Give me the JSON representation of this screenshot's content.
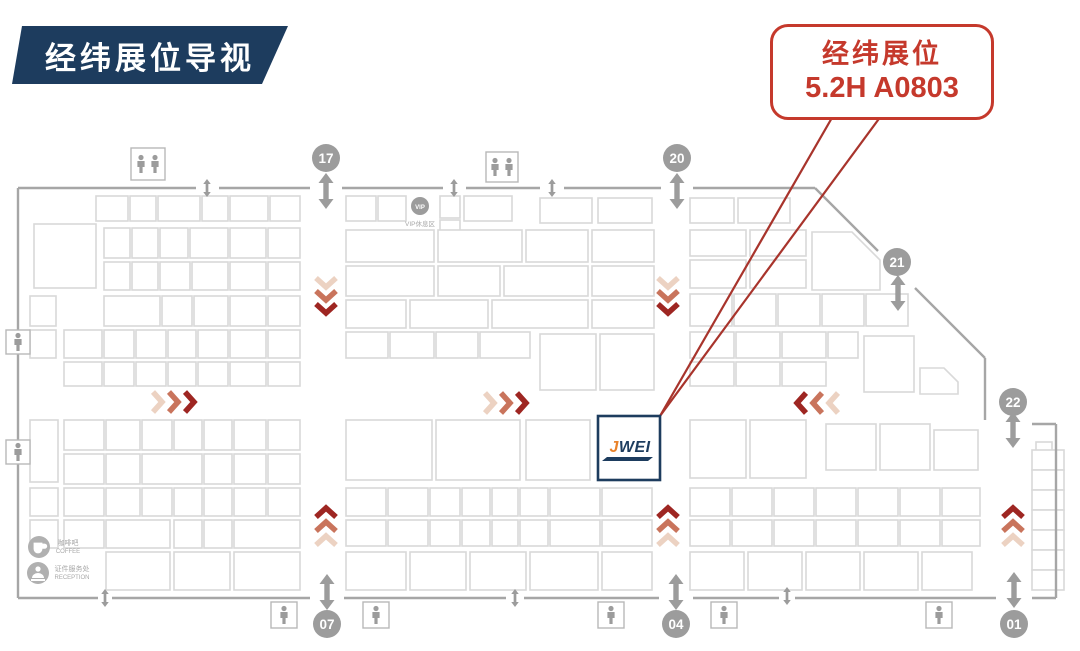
{
  "banner": {
    "title": "经纬展位导视"
  },
  "callout": {
    "line1": "经纬展位",
    "line2": "5.2H A0803"
  },
  "jwei_booth": {
    "logo_j": "J",
    "logo_wei": "WEI"
  },
  "gates": {
    "g17": "17",
    "g20": "20",
    "g21": "21",
    "g22": "22",
    "g07": "07",
    "g04": "04",
    "g01": "01"
  },
  "facilities": {
    "vip_label": "VIP休息区",
    "coffee_zh": "咖啡吧",
    "coffee_en": "COFFEE",
    "reception_zh": "证件服务处",
    "reception_en": "RECEPTION"
  },
  "icons": {
    "restroom": "wc-figures",
    "vip": "vip-lounge-circle",
    "coffee": "coffee-cup-circle",
    "reception": "reception-desk-circle",
    "gate_arrow": "double-headed-arrow",
    "flow": "red-chevron-arrows"
  },
  "colors": {
    "navy": "#1d3c5e",
    "callout_red": "#c5392c",
    "leader_red": "#a8342c",
    "wall_gray": "#a6a6a6",
    "gate_gray": "#9c9c9c",
    "booth_outline": "#d9d9d9",
    "logo_orange": "#e9822a",
    "chevron_dark": "#9e2622",
    "chevron_mid": "#c9745c",
    "chevron_light": "#ecd2c2"
  }
}
